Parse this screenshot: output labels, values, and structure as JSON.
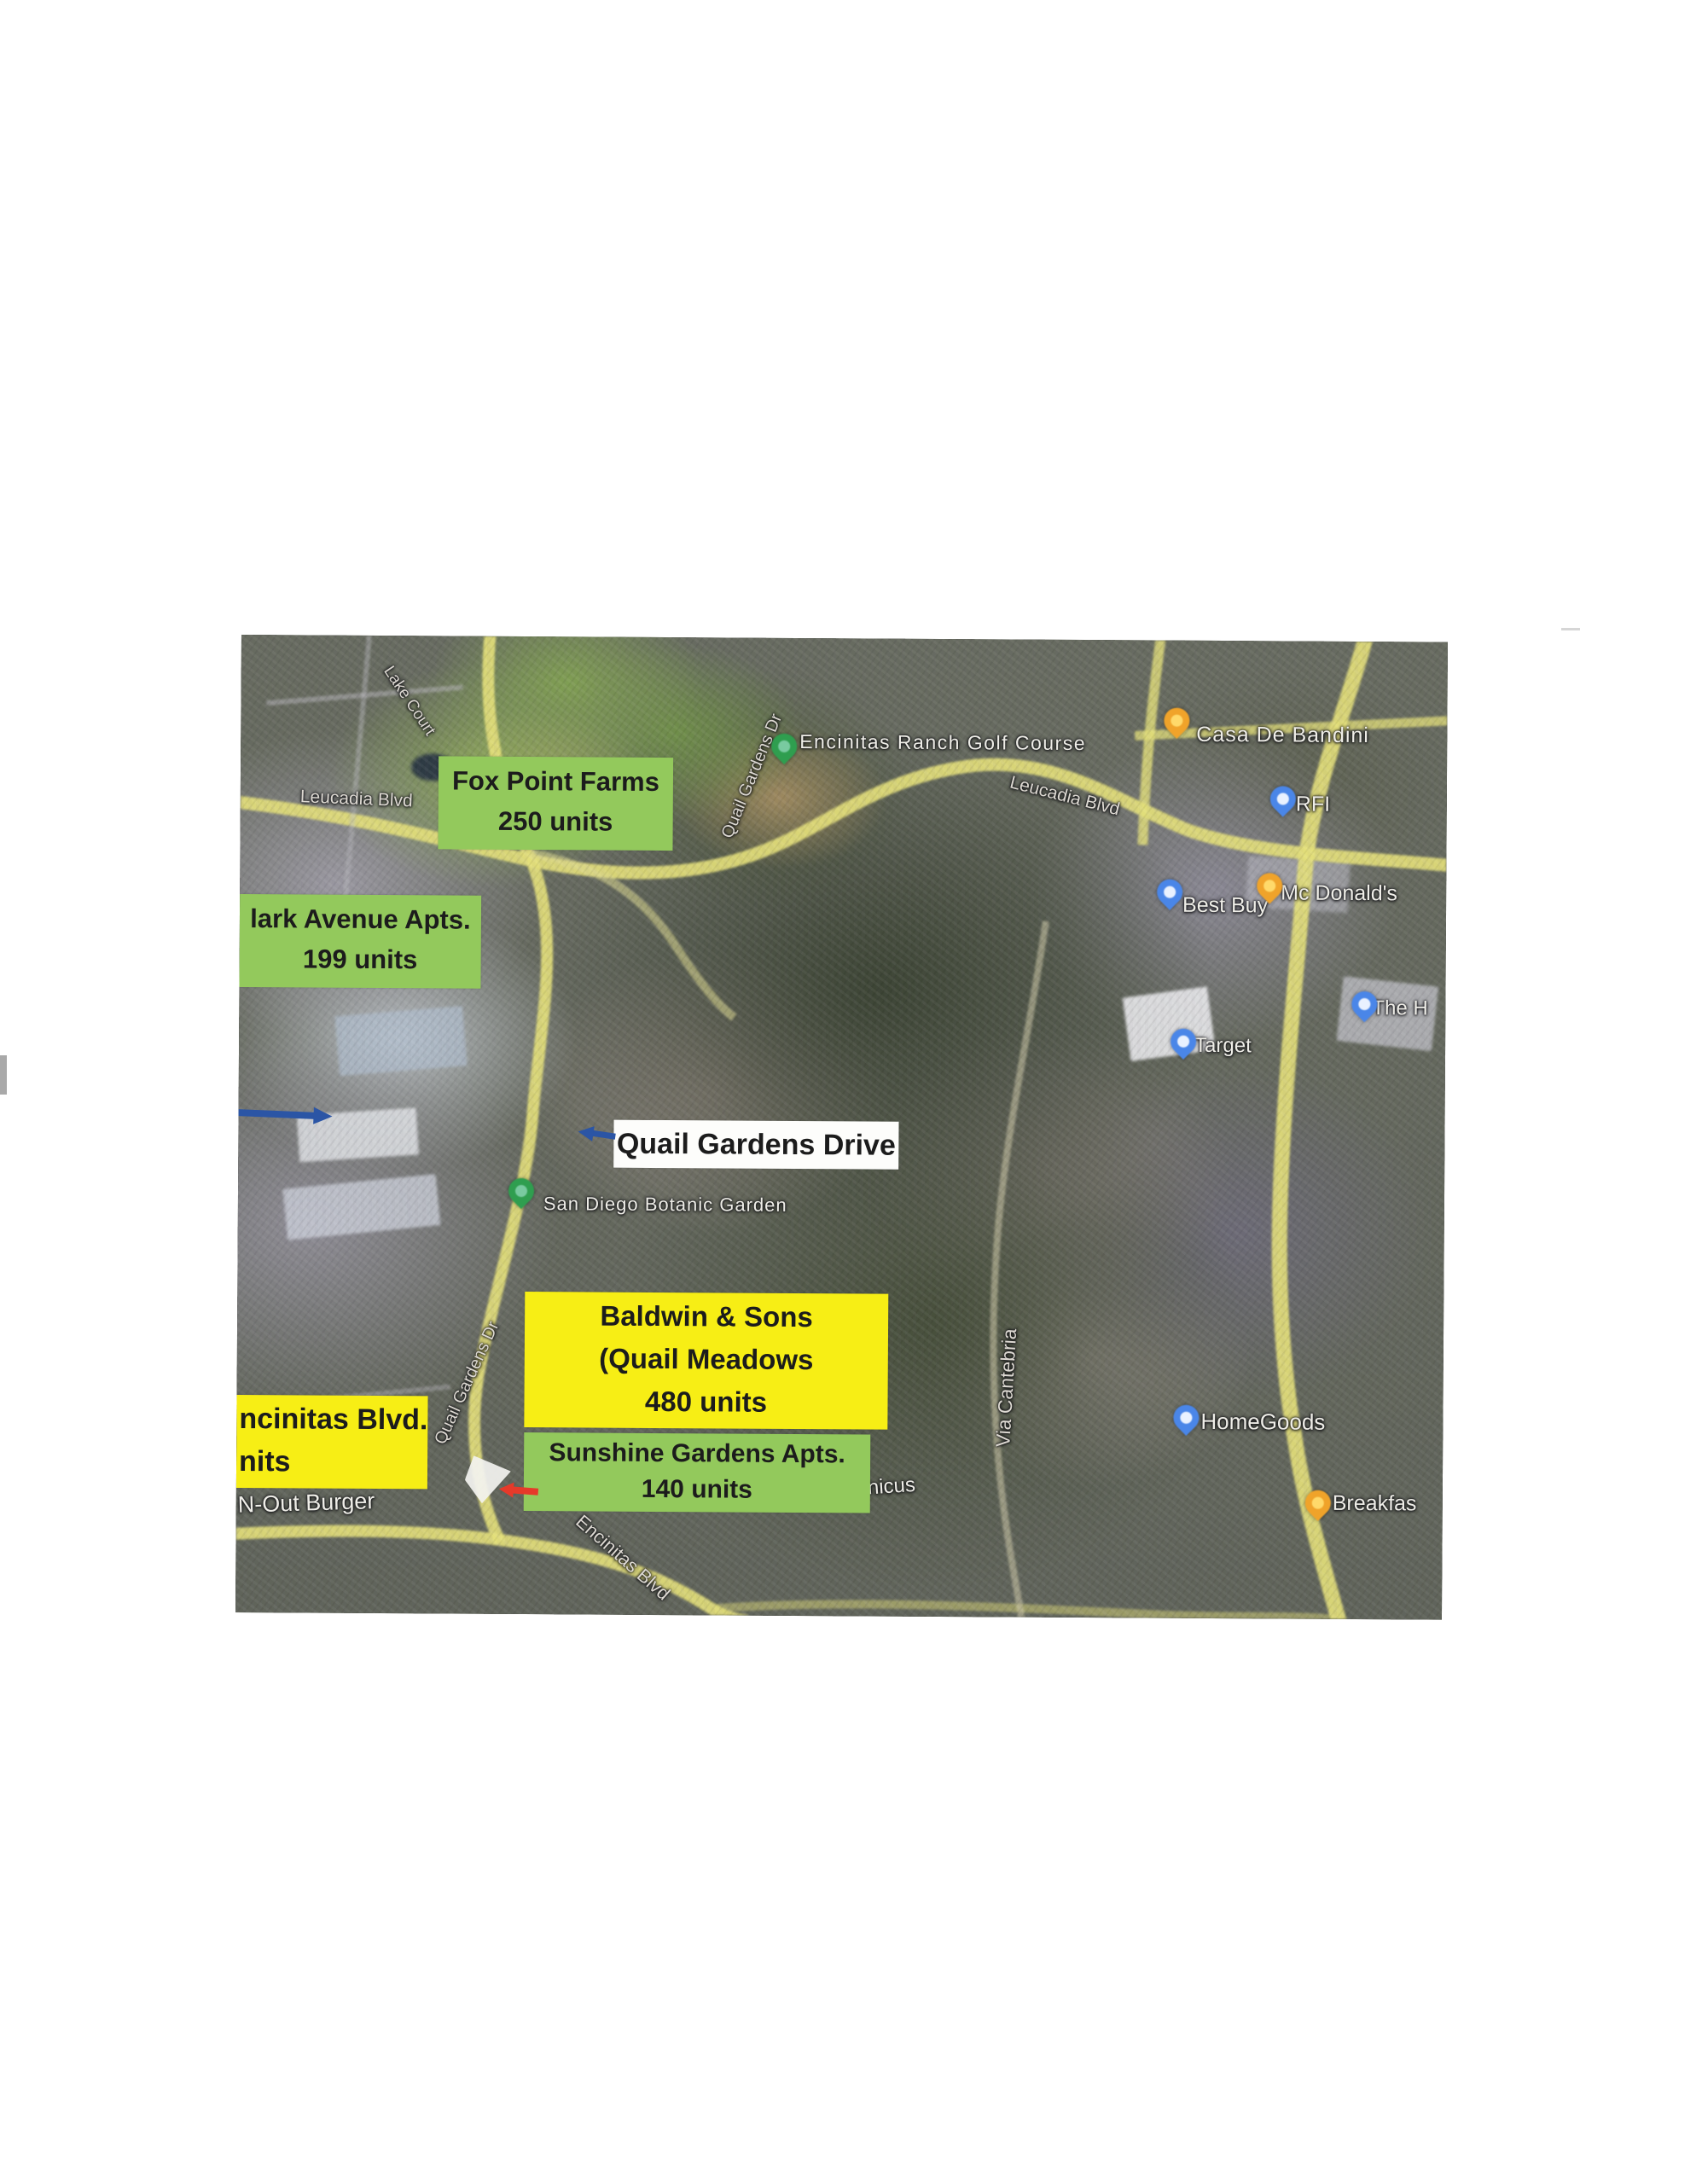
{
  "document": {
    "type": "scanned aerial map exhibit of Encinitas housing developments"
  },
  "map": {
    "annotations": {
      "fox_point": {
        "line1": "Fox Point Farms",
        "line2": "250 units"
      },
      "clark_avenue": {
        "line1": "lark Avenue Apts.",
        "line2": "199 units"
      },
      "quail_gardens_drive_label": "Quail Gardens Drive",
      "baldwin": {
        "line1": "Baldwin & Sons",
        "line2": "(Quail Meadows",
        "line3": "480 units"
      },
      "encinitas_blvd_label": {
        "line1": "ncinitas Blvd.",
        "line2": "nits"
      },
      "sunshine": {
        "line1": "Sunshine Gardens Apts.",
        "line2": "140 units"
      }
    },
    "road_labels": {
      "leucadia_west": "Leucadia Blvd",
      "leucadia_east": "Leucadia Blvd",
      "lake_court": "Lake Court",
      "quail_north": "Quail Gardens Dr",
      "quail_south": "Quail Gardens Dr",
      "via_cantebria": "Via Cantebria",
      "encinitas_blvd": "Encinitas Blvd"
    },
    "places": {
      "golf_course": "Encinitas Ranch Golf Course",
      "casa_de_bandini": "Casa De Bandini",
      "rfi": "RFI",
      "best_buy": "Best Buy",
      "mcdonalds": "Mc Donald's",
      "target": "Target",
      "the_home_depot_partial": "The H",
      "san_diego_botanic_garden": "San Diego Botanic Garden",
      "homegoods": "HomeGoods",
      "breakfast_partial": "Breakfas",
      "in_n_out_partial": "N-Out Burger",
      "copernicus_partial": "nicus"
    },
    "colors": {
      "green_label_bg": "#93c95c",
      "yellow_label_bg": "#f7ee15",
      "white_label_bg": "#fdfdfb",
      "label_text": "#1c1c1c",
      "road_yellow": "#e4e07a",
      "pin_green": "#2f9e4f",
      "pin_orange": "#f0a32a",
      "pin_blue": "#4a86e8",
      "arrow_blue": "#2b55a5",
      "arrow_red": "#e63a2a"
    }
  }
}
